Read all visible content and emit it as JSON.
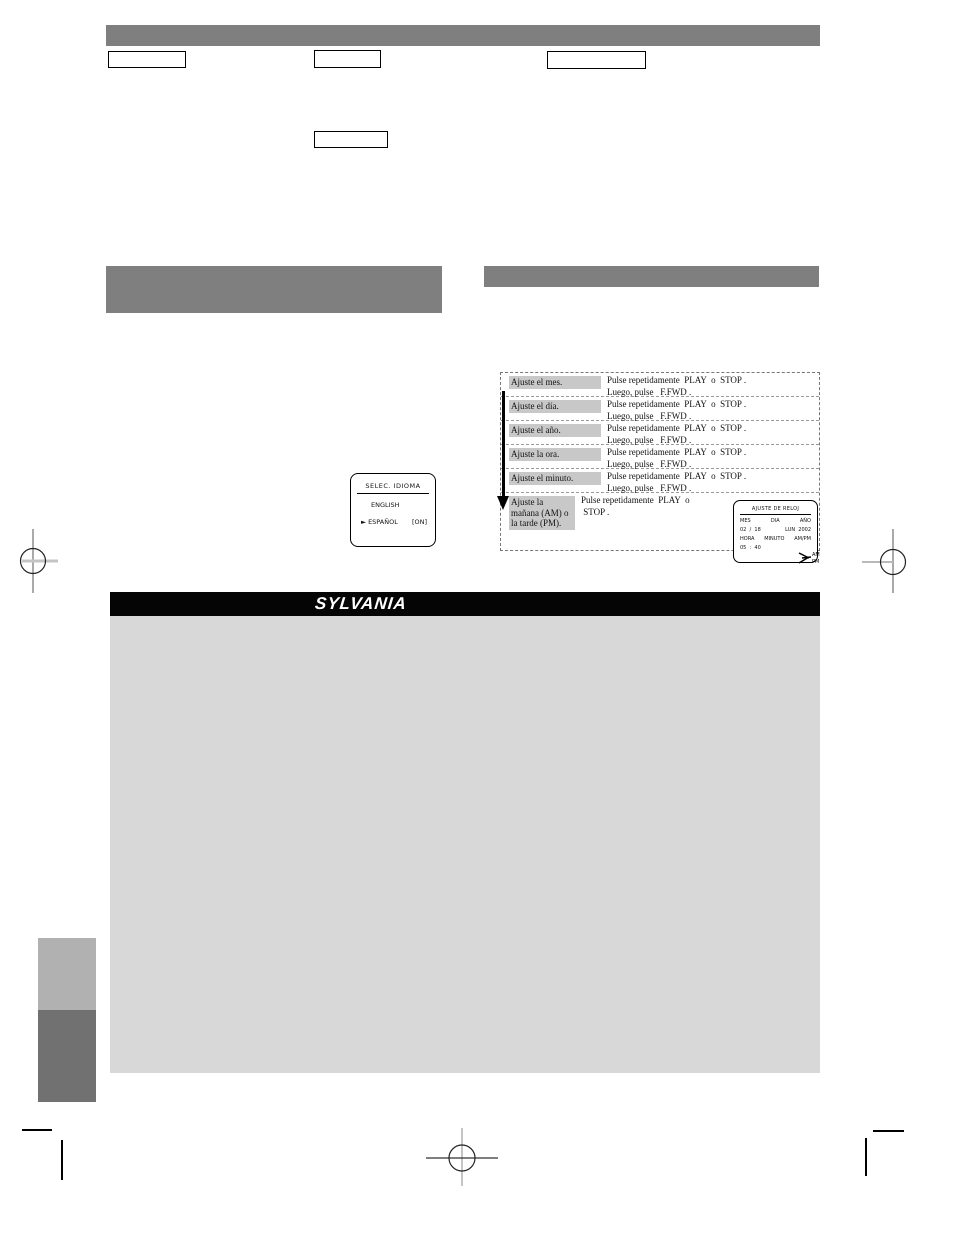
{
  "steps_table": {
    "rows": [
      {
        "label": "Ajuste el mes.",
        "line1": "Pulse repetidamente  PLAY  o  STOP .",
        "line2": "Luego, pulse   F.FWD ."
      },
      {
        "label": "Ajuste el día.",
        "line1": "Pulse repetidamente  PLAY  o  STOP .",
        "line2": "Luego, pulse   F.FWD ."
      },
      {
        "label": "Ajuste el año.",
        "line1": "Pulse repetidamente  PLAY  o  STOP .",
        "line2": "Luego, pulse   F.FWD ."
      },
      {
        "label": "Ajuste la ora.",
        "line1": "Pulse repetidamente  PLAY  o  STOP .",
        "line2": "Luego, pulse   F.FWD ."
      },
      {
        "label": "Ajuste el minuto.",
        "line1": "Pulse repetidamente  PLAY  o  STOP .",
        "line2": "Luego, pulse   F.FWD ."
      },
      {
        "label": "Ajuste la\nmañana (AM) o\nla tarde (PM).",
        "line1": "Pulse repetidamente  PLAY  o",
        "line2": " STOP ."
      }
    ]
  },
  "language_screen": {
    "title": "SELEC. IDIOMA",
    "option1": "ENGLISH",
    "option2": "► ESPAÑOL",
    "option2_status": "[ON]"
  },
  "clock_screen": {
    "title": "AJUSTE DE RELOJ",
    "col_mes": "MES",
    "col_dia": "DIA",
    "col_ano": "AÑO",
    "date_value": "02  /  18",
    "weekday_year": "LUN  2002",
    "col_hora": "HORA",
    "col_minuto": "MINUTO",
    "col_ampm": "AM/PM",
    "time_value": "05  :  40",
    "am": "AM",
    "pm": "PM"
  },
  "brand": {
    "logo_text": "SYLVANIA"
  },
  "colors": {
    "section_bar": "#7f7f7f",
    "label_highlight": "#c8c8c8",
    "panel": "#d8d8d8",
    "side_tab_light": "#b1b1b1",
    "side_tab_dark": "#717171",
    "brand_bar": "#050505"
  }
}
